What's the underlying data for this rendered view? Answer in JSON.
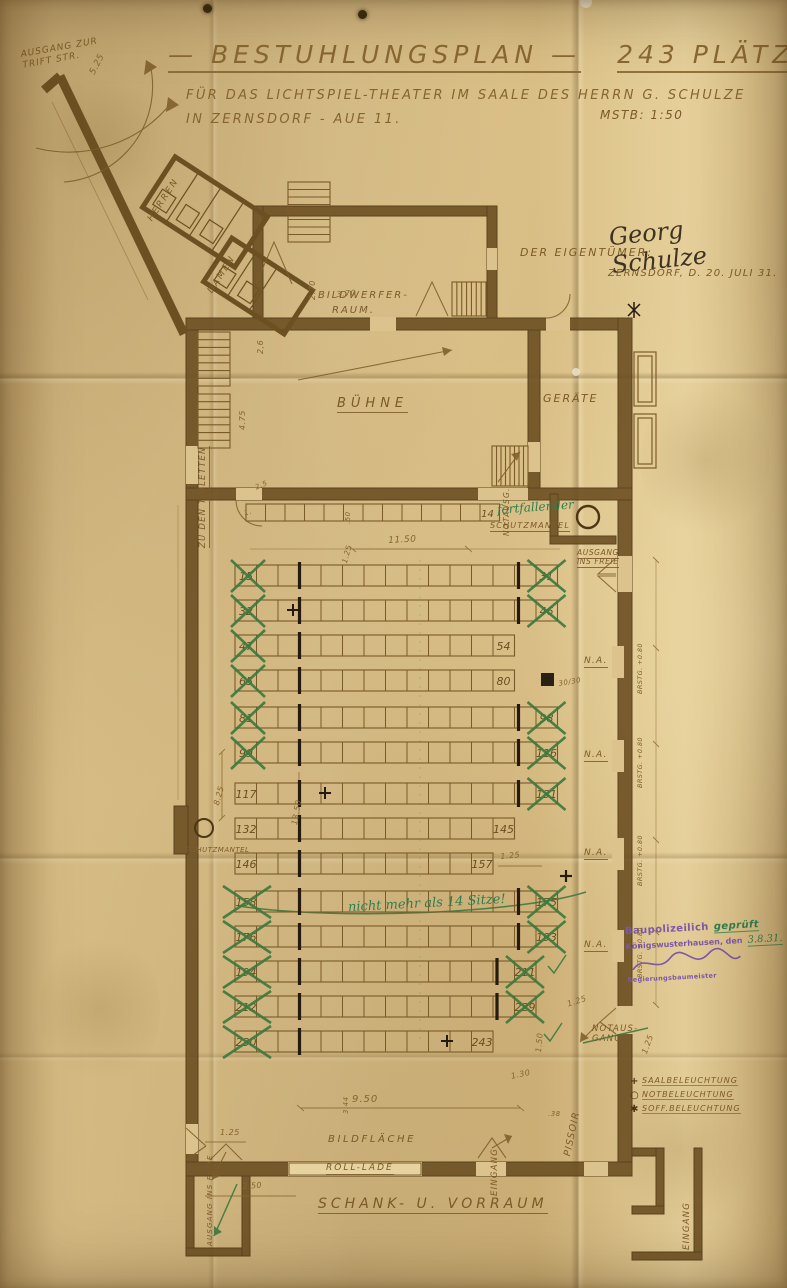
{
  "title": {
    "s1": "— BESTUHLUNGSPLAN —",
    "s2": "243 PLÄTZE —",
    "sub1": "FÜR DAS LICHTSPIEL-THEATER IM SAALE DES HERRN G. SCHULZE",
    "sub2": "IN ZERNSDORF - AUE 11.",
    "scale": "MSTB: 1:50"
  },
  "owner": {
    "label": "DER EIGENTÜMER:",
    "signature": "Georg Schulze",
    "place_date": "ZERNSDORF, D. 20. JULI 31."
  },
  "rooms": {
    "buehne": "BÜHNE",
    "geraete": "GERÄTE",
    "bildwerfer1": "BILDWERFER-",
    "bildwerfer2": "RAUM.",
    "herren": "HERREN",
    "damen": "DAMEN",
    "schank": "SCHANK- U. VORRAUM",
    "bildflaeche": "BILDFLÄCHE",
    "rolllade": "ROLL-LADE"
  },
  "exits": {
    "trift1": "AUSGANG ZUR",
    "trift2": "TRIFT STR.",
    "toiletten": "ZU DEN TOILETTEN",
    "schutz_top": "SCHUTZMANTEL",
    "schutz_left": "SCHUTZMANTEL",
    "insfreie1": "AUSGANG",
    "insfreie2": "INS FREIE",
    "notausg_v": "NOTAUSG.",
    "notaus1": "NOTAUS-",
    "notaus2": "GANG",
    "pissoir": "PISSOIR",
    "eingang1": "EINGANG",
    "eingang2": "EINGANG",
    "ausgang_bl": "AUSGANG INS FREIE"
  },
  "right_wall": {
    "na": [
      "N.A.",
      "N.A.",
      "N.A.",
      "N.A."
    ],
    "brstg": [
      "BRSTG. +0.80",
      "BRSTG. +0.80",
      "BRSTG. +0.80",
      "BRSTG. +0.80"
    ]
  },
  "dims": {
    "corridor": "5.25",
    "v26": "2,6",
    "bw_h": "2.70",
    "bw_w": "3.70",
    "stage_h": "4.75",
    "toilet": "2.5",
    "one": "1.",
    "strip_h": ".50",
    "strip_gap": "1.25",
    "aisle": "11.50",
    "hall1": "13.50",
    "hall2": "8.25",
    "row125": "1.25",
    "row125b": "1.25",
    "exit150": "1.50",
    "d130": "1.30",
    "screen": "9.50",
    "sh344": "3.44",
    "bl125": "1.25",
    "bl250": "2.50",
    "p38": ".38",
    "na125": "1.25",
    "sq": "30/30"
  },
  "front_strip": {
    "cells": 13,
    "right_label": "14"
  },
  "seat_rows": [
    {
      "left": "15",
      "right": "31",
      "cells": 15,
      "cross_left": true,
      "cross_right": true
    },
    {
      "left": "32",
      "right": "46",
      "cells": 15,
      "cross_left": true,
      "cross_right": true,
      "plus": true
    },
    {
      "left": "47",
      "right": "54",
      "cells": 13,
      "cross_left": true,
      "cross_right": false
    },
    {
      "left": "65",
      "right": "80",
      "cells": 13,
      "cross_left": true,
      "cross_right": false
    },
    {
      "left": "81",
      "right": "98",
      "cells": 15,
      "cross_left": true,
      "cross_right": true
    },
    {
      "left": "99",
      "right": "116",
      "cells": 15,
      "cross_left": true,
      "cross_right": true
    },
    {
      "left": "117",
      "right": "131",
      "cells": 15,
      "cross_left": false,
      "cross_right": true,
      "plus": true
    },
    {
      "left": "132",
      "right": "145",
      "cells": 13,
      "cross_left": false,
      "cross_right": false
    },
    {
      "left": "146",
      "right": "157",
      "cells": 12,
      "cross_left": false,
      "cross_right": false
    },
    {
      "left": "158",
      "right": "175",
      "cells": 15,
      "cross_left": true,
      "cross_right": true
    },
    {
      "left": "176",
      "right": "193",
      "cells": 15,
      "cross_left": true,
      "cross_right": true
    },
    {
      "left": "194",
      "right": "211",
      "cells": 14,
      "cross_left": true,
      "cross_right": true
    },
    {
      "left": "212",
      "right": "229",
      "cells": 14,
      "cross_left": true,
      "cross_right": true
    },
    {
      "left": "230",
      "right": "243",
      "cells": 12,
      "cross_left": true,
      "cross_right": false,
      "plus": true
    }
  ],
  "green": {
    "fortfallender": "fortfallender",
    "note": "nicht mehr als 14 Sitze!"
  },
  "stamp": {
    "l1a": "Baupolizeilich",
    "l1b": "geprüft",
    "l2a": "Königswusterhausen, den",
    "l2b": "3.8.31.",
    "l4": "Regierungsbaumeister"
  },
  "legend": {
    "items": [
      {
        "symbol": "+",
        "label": "SAALBELEUCHTUNG"
      },
      {
        "symbol": "○",
        "label": "NOTBELEUCHTUNG"
      },
      {
        "symbol": "✱",
        "label": "SOFF.BELEUCHTUNG"
      }
    ]
  }
}
